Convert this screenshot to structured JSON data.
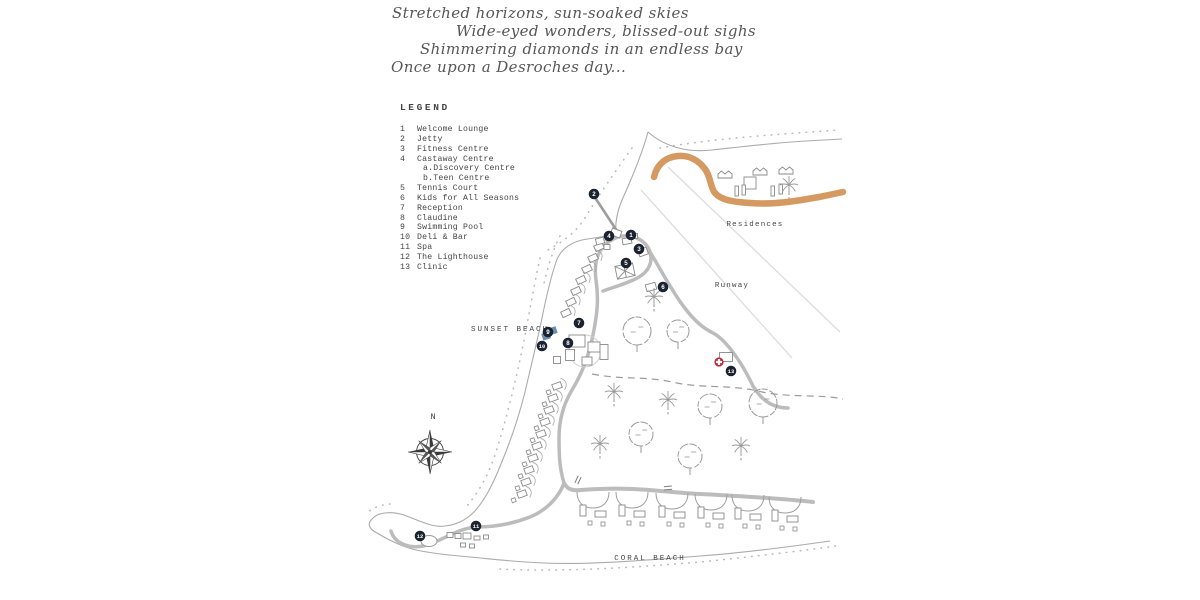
{
  "poem": {
    "lines": [
      {
        "text": "Stretched horizons, sun-soaked skies",
        "x": 392,
        "y": 4
      },
      {
        "text": "Wide-eyed wonders, blissed-out sighs",
        "x": 456,
        "y": 22
      },
      {
        "text": "Shimmering diamonds in an endless bay",
        "x": 420,
        "y": 40
      },
      {
        "text": "Once upon a Desroches day...",
        "x": 391,
        "y": 58
      }
    ]
  },
  "legend": {
    "title": "LEGEND",
    "items": [
      {
        "num": "1",
        "label": "Welcome Lounge",
        "sub": false
      },
      {
        "num": "2",
        "label": "Jetty",
        "sub": false
      },
      {
        "num": "3",
        "label": "Fitness Centre",
        "sub": false
      },
      {
        "num": "4",
        "label": "Castaway Centre",
        "sub": false
      },
      {
        "num": "",
        "label": "a.Discovery Centre",
        "sub": true
      },
      {
        "num": "",
        "label": "b.Teen Centre",
        "sub": true
      },
      {
        "num": "5",
        "label": "Tennis Court",
        "sub": false
      },
      {
        "num": "6",
        "label": "Kids for All Seasons",
        "sub": false
      },
      {
        "num": "7",
        "label": "Reception",
        "sub": false
      },
      {
        "num": "8",
        "label": "Claudine",
        "sub": false
      },
      {
        "num": "9",
        "label": "Swimming Pool",
        "sub": false
      },
      {
        "num": "10",
        "label": "Deli & Bar",
        "sub": false
      },
      {
        "num": "11",
        "label": "Spa",
        "sub": false
      },
      {
        "num": "12",
        "label": "The Lighthouse",
        "sub": false
      },
      {
        "num": "13",
        "label": "Clinic",
        "sub": false
      }
    ]
  },
  "map": {
    "labels": [
      {
        "id": "sunset-beach",
        "text": "SUNSET BEACH",
        "x": 510,
        "y": 331,
        "ls": 2,
        "size": 7.5
      },
      {
        "id": "residences",
        "text": "Residences",
        "x": 755,
        "y": 226,
        "ls": 1.2,
        "size": 7.5
      },
      {
        "id": "runway",
        "text": "Runway",
        "x": 732,
        "y": 287,
        "ls": 1.2,
        "size": 7.5
      },
      {
        "id": "coral-beach",
        "text": "CORAL BEACH",
        "x": 650,
        "y": 560,
        "ls": 2,
        "size": 7.5
      }
    ],
    "compass": {
      "x": 430,
      "y": 452,
      "label": "N"
    },
    "markers": [
      {
        "num": "1",
        "name": "Welcome Lounge",
        "x": 631,
        "y": 235
      },
      {
        "num": "2",
        "name": "Jetty",
        "x": 594,
        "y": 194
      },
      {
        "num": "3",
        "name": "Fitness Centre",
        "x": 639,
        "y": 249
      },
      {
        "num": "4",
        "name": "Castaway Centre",
        "x": 609,
        "y": 236
      },
      {
        "num": "5",
        "name": "Tennis Court",
        "x": 626,
        "y": 263
      },
      {
        "num": "6",
        "name": "Kids for All Seasons",
        "x": 663,
        "y": 287
      },
      {
        "num": "7",
        "name": "Reception",
        "x": 579,
        "y": 323
      },
      {
        "num": "8",
        "name": "Claudine",
        "x": 568,
        "y": 343
      },
      {
        "num": "9",
        "name": "Swimming Pool",
        "x": 548,
        "y": 332
      },
      {
        "num": "10",
        "name": "Deli & Bar",
        "x": 542,
        "y": 346
      },
      {
        "num": "11",
        "name": "Spa",
        "x": 476,
        "y": 526
      },
      {
        "num": "12",
        "name": "The Lighthouse",
        "x": 420,
        "y": 536
      },
      {
        "num": "13",
        "name": "Clinic",
        "x": 731,
        "y": 371
      }
    ],
    "colors": {
      "marker": "#1c2330",
      "sand_road": "#d49a62",
      "pool": "#5d82aa",
      "cross": "#c6273a",
      "road": "#bcbcbc",
      "coast": "#aaaaaa",
      "text": "#454545",
      "tree": "#9a9a9a",
      "building": "#8a8a8a"
    },
    "decor": {
      "villas_upper": [
        [
          599,
          247
        ],
        [
          593,
          258
        ],
        [
          587,
          269
        ],
        [
          581,
          280
        ],
        [
          576,
          291
        ],
        [
          571,
          302
        ],
        [
          566,
          313
        ]
      ],
      "villas_lower": [
        [
          557,
          386
        ],
        [
          553,
          398
        ],
        [
          549,
          410
        ],
        [
          545,
          422
        ],
        [
          541,
          434
        ],
        [
          537,
          446
        ],
        [
          533,
          458
        ],
        [
          529,
          470
        ],
        [
          526,
          482
        ],
        [
          522,
          494
        ]
      ],
      "beach_clusters": [
        [
          593,
          0
        ],
        [
          632,
          0
        ],
        [
          672,
          1
        ],
        [
          711,
          2
        ],
        [
          748,
          3
        ],
        [
          785,
          5
        ]
      ],
      "buildings": [
        [
          616,
          233,
          10,
          7,
          20
        ],
        [
          627,
          241,
          9,
          6,
          -10
        ],
        [
          634,
          236,
          7,
          5,
          0
        ],
        [
          600,
          241,
          8,
          6,
          -15
        ],
        [
          607,
          247,
          6,
          5,
          0
        ],
        [
          643,
          252,
          9,
          7,
          -20
        ],
        [
          651,
          287,
          10,
          7,
          -15
        ],
        [
          577,
          341,
          16,
          12,
          0
        ],
        [
          570,
          355,
          9,
          11,
          0
        ],
        [
          594,
          347,
          12,
          10,
          0
        ],
        [
          587,
          361,
          10,
          8,
          0
        ],
        [
          604,
          352,
          8,
          15,
          0
        ],
        [
          557,
          360,
          7,
          7,
          0
        ],
        [
          726,
          357,
          13,
          9,
          0
        ],
        [
          450,
          535,
          6,
          5,
          0
        ],
        [
          458,
          536,
          6,
          5,
          0
        ],
        [
          467,
          536,
          8,
          6,
          0
        ],
        [
          477,
          538,
          6,
          4,
          0
        ],
        [
          486,
          537,
          5,
          4,
          0
        ],
        [
          463,
          545,
          5,
          4,
          0
        ],
        [
          472,
          546,
          5,
          4,
          0
        ],
        [
          750,
          183,
          12,
          12,
          0
        ]
      ],
      "residence_huts": [
        [
          718,
          171
        ],
        [
          753,
          168
        ],
        [
          779,
          167
        ]
      ],
      "residence_bars": [
        [
          735,
          186
        ],
        [
          742,
          185
        ],
        [
          771,
          186
        ],
        [
          779,
          184
        ]
      ],
      "trees_round": [
        [
          637,
          331,
          14
        ],
        [
          678,
          331,
          11
        ],
        [
          710,
          406,
          12
        ],
        [
          763,
          403,
          14
        ],
        [
          641,
          434,
          12
        ],
        [
          690,
          456,
          12
        ]
      ],
      "palms": [
        [
          654,
          297
        ],
        [
          614,
          392
        ],
        [
          668,
          400
        ],
        [
          600,
          444
        ],
        [
          741,
          446
        ],
        [
          789,
          185
        ]
      ],
      "gates": [
        [
          578,
          480,
          25
        ],
        [
          668,
          488,
          85
        ]
      ]
    }
  }
}
